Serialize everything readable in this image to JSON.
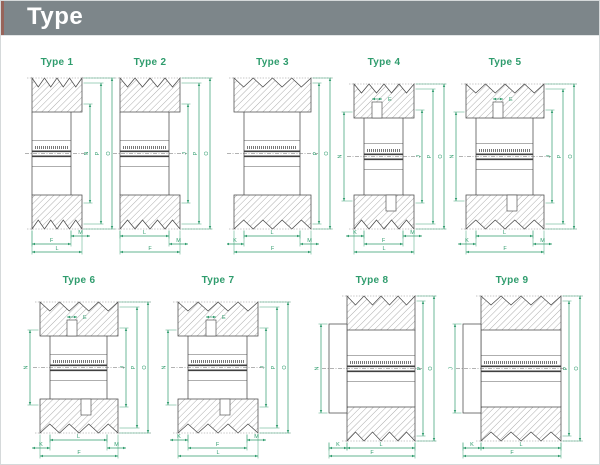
{
  "header": {
    "title": "Type"
  },
  "colors": {
    "dimension_green": "#2f9c6d",
    "drawing_line": "#4a4a4a",
    "header_bar": "#7d868a",
    "header_accent": "#97645a",
    "title_text": "#ffffff",
    "page_background": "#ffffff",
    "page_border": "#d5d9da"
  },
  "diagrams": [
    {
      "id": "type-1",
      "label": "Type 1",
      "variant": "right-step",
      "top_dims": [],
      "left_dims": [],
      "right_dims": [
        "N",
        "P",
        "O"
      ],
      "bottom_dims": [
        "M",
        "F",
        "L"
      ]
    },
    {
      "id": "type-2",
      "label": "Type 2",
      "variant": "right-step",
      "top_dims": [],
      "left_dims": [],
      "right_dims": [
        "J",
        "P",
        "O"
      ],
      "bottom_dims": [
        "L",
        "M",
        "F"
      ]
    },
    {
      "id": "type-3",
      "label": "Type 3",
      "variant": "both-step",
      "top_dims": [],
      "left_dims": [],
      "right_dims": [
        "P",
        "O"
      ],
      "bottom_dims": [
        "K",
        "L",
        "M",
        "F"
      ]
    },
    {
      "id": "type-4",
      "label": "Type 4",
      "variant": "bushing",
      "top_dims": [
        "E"
      ],
      "left_dims": [
        "N"
      ],
      "right_dims": [
        "J",
        "P",
        "O"
      ],
      "bottom_dims": [
        "K",
        "M",
        "F",
        "L"
      ]
    },
    {
      "id": "type-5",
      "label": "Type 5",
      "variant": "bushing",
      "top_dims": [
        "E"
      ],
      "left_dims": [
        "N"
      ],
      "right_dims": [
        "J",
        "P",
        "O"
      ],
      "bottom_dims": [
        "K",
        "L",
        "M",
        "F"
      ]
    },
    {
      "id": "type-6",
      "label": "Type 6",
      "variant": "bushing",
      "top_dims": [
        "E"
      ],
      "left_dims": [
        "N"
      ],
      "right_dims": [
        "J",
        "P",
        "O"
      ],
      "bottom_dims": [
        "K",
        "L",
        "M",
        "F"
      ]
    },
    {
      "id": "type-7",
      "label": "Type 7",
      "variant": "bushing",
      "top_dims": [
        "E"
      ],
      "left_dims": [
        "N"
      ],
      "right_dims": [
        "J",
        "P",
        "O"
      ],
      "bottom_dims": [
        "K",
        "F",
        "M",
        "L"
      ]
    },
    {
      "id": "type-8",
      "label": "Type 8",
      "variant": "hub-left",
      "top_dims": [],
      "left_dims": [
        "N"
      ],
      "right_dims": [
        "P",
        "O"
      ],
      "bottom_dims": [
        "K",
        "L",
        "F"
      ]
    },
    {
      "id": "type-9",
      "label": "Type 9",
      "variant": "hub-left",
      "top_dims": [],
      "left_dims": [
        "J"
      ],
      "right_dims": [
        "P",
        "O"
      ],
      "bottom_dims": [
        "K",
        "L",
        "F"
      ]
    }
  ]
}
